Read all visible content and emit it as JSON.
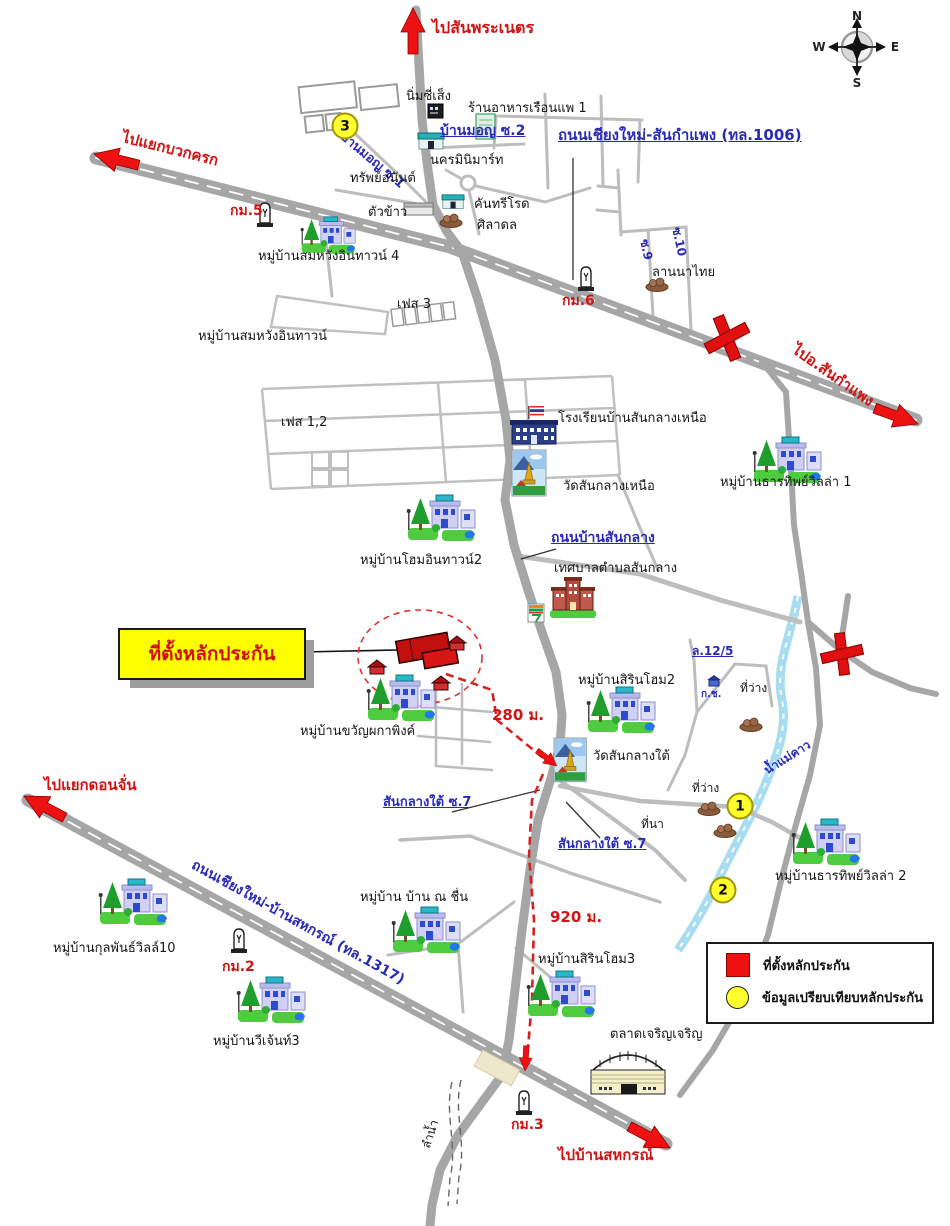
{
  "callout": {
    "label": "ที่ตั้งหลักประกัน"
  },
  "legend": {
    "items": [
      {
        "symbol": "red-square",
        "label": "ที่ตั้งหลักประกัน"
      },
      {
        "symbol": "yellow-circle",
        "label": "ข้อมูลเปรียบเทียบหลักประกัน"
      }
    ]
  },
  "compass": {
    "n": "N",
    "e": "E",
    "s": "S",
    "w": "W"
  },
  "colors": {
    "label_red": "#d01414",
    "label_blue": "#2a2ab8",
    "road_gray": "#a6a6a6",
    "route_red": "#d42222",
    "highlight_yellow": "#ffff00",
    "collateral_red": "#ee1111",
    "badge_yellow": "#ffff2e",
    "stream_blue": "#a8dcf0"
  },
  "map": {
    "labels": [
      {
        "id": "to-sanphranet",
        "text": "ไปสันพระเนตร",
        "x": 432,
        "y": 20,
        "size": 16,
        "color": "red"
      },
      {
        "id": "nim-si-seng",
        "text": "นิ่มซี่เส็ง",
        "x": 406,
        "y": 90,
        "size": 13,
        "color": "black"
      },
      {
        "id": "ruen-phae-restaurant",
        "text": "ร้านอาหารเรือนแพ 1",
        "x": 468,
        "y": 102,
        "size": 13,
        "color": "black"
      },
      {
        "id": "baan-mon-soi2",
        "text": "บ้านมอญ ซ.2",
        "x": 440,
        "y": 124,
        "size": 14,
        "color": "blue",
        "underline": true
      },
      {
        "id": "baan-mon-soi1",
        "text": "บ้านมอญ ซ.1",
        "x": 346,
        "y": 130,
        "size": 13,
        "color": "blue",
        "rot": 40
      },
      {
        "id": "nakorn-minimart",
        "text": "นครมินิมาร์ท",
        "x": 430,
        "y": 154,
        "size": 13,
        "color": "black"
      },
      {
        "id": "sap-anan",
        "text": "ทรัพย์อนันต์",
        "x": 350,
        "y": 172,
        "size": 13,
        "color": "black"
      },
      {
        "id": "tua-khao",
        "text": "ตัวข้าว",
        "x": 368,
        "y": 206,
        "size": 13,
        "color": "black"
      },
      {
        "id": "country-road",
        "text": "คันทรีโรด",
        "x": 474,
        "y": 198,
        "size": 13,
        "color": "black"
      },
      {
        "id": "siladon",
        "text": "ศิลาดล",
        "x": 477,
        "y": 219,
        "size": 13,
        "color": "black"
      },
      {
        "id": "road-1006",
        "text": "ถนนเชียงใหม่-สันกำแพง (ทล.1006)",
        "x": 558,
        "y": 128,
        "size": 15,
        "color": "blue",
        "underline": true
      },
      {
        "id": "to-yaek-buak-krok",
        "text": "ไปแยกบวกครก",
        "x": 124,
        "y": 130,
        "size": 15,
        "color": "red",
        "rot": 14
      },
      {
        "id": "km5",
        "text": "กม.5",
        "x": 230,
        "y": 204,
        "size": 14,
        "color": "red"
      },
      {
        "id": "somwang-intown4",
        "text": "หมู่บ้านสมหวังอินทาวน์ 4",
        "x": 258,
        "y": 250,
        "size": 13,
        "color": "black"
      },
      {
        "id": "km6",
        "text": "กม.6",
        "x": 562,
        "y": 294,
        "size": 14,
        "color": "red"
      },
      {
        "id": "soi9",
        "text": "ซ.9",
        "x": 650,
        "y": 238,
        "size": 12,
        "color": "blue",
        "rot": 78
      },
      {
        "id": "soi10",
        "text": "ซ.10",
        "x": 682,
        "y": 226,
        "size": 12,
        "color": "blue",
        "rot": 78
      },
      {
        "id": "lanna-thai",
        "text": "ลานนาไทย",
        "x": 652,
        "y": 266,
        "size": 13,
        "color": "black"
      },
      {
        "id": "to-sankamphaeng",
        "text": "ไปอ.สันกำแพง",
        "x": 798,
        "y": 342,
        "size": 15,
        "color": "red",
        "rot": 35
      },
      {
        "id": "phase3",
        "text": "เฟส 3",
        "x": 397,
        "y": 298,
        "size": 13,
        "color": "black"
      },
      {
        "id": "somwang-intown",
        "text": "หมู่บ้านสมหวังอินทาวน์",
        "x": 198,
        "y": 330,
        "size": 13,
        "color": "black"
      },
      {
        "id": "phase12",
        "text": "เฟส 1,2",
        "x": 281,
        "y": 416,
        "size": 13,
        "color": "black"
      },
      {
        "id": "school-sanklang-nuea",
        "text": "โรงเรียนบ้านสันกลางเหนือ",
        "x": 558,
        "y": 412,
        "size": 13,
        "color": "black"
      },
      {
        "id": "wat-sanklang-nuea",
        "text": "วัดสันกลางเหนือ",
        "x": 563,
        "y": 480,
        "size": 13,
        "color": "black"
      },
      {
        "id": "thantip-villa1",
        "text": "หมู่บ้านธารทิพย์วิลล่า 1",
        "x": 720,
        "y": 476,
        "size": 13,
        "color": "black"
      },
      {
        "id": "home-intown2",
        "text": "หมู่บ้านโฮมอินทาวน์2",
        "x": 360,
        "y": 554,
        "size": 13,
        "color": "black"
      },
      {
        "id": "road-ban-sanklang",
        "text": "ถนนบ้านสันกลาง",
        "x": 551,
        "y": 531,
        "size": 14,
        "color": "blue",
        "underline": true
      },
      {
        "id": "municipality-sanklang",
        "text": "เทศบาลตำบลสันกลาง",
        "x": 554,
        "y": 562,
        "size": 13,
        "color": "black"
      },
      {
        "id": "khwan-phaka-ping",
        "text": "หมู่บ้านขวัญผกาพิงค์",
        "x": 300,
        "y": 725,
        "size": 13,
        "color": "black"
      },
      {
        "id": "dist-280m",
        "text": "280 ม.",
        "x": 492,
        "y": 708,
        "size": 15,
        "color": "red"
      },
      {
        "id": "sirin-home2",
        "text": "หมู่บ้านสิรินโฮม2",
        "x": 578,
        "y": 674,
        "size": 13,
        "color": "black"
      },
      {
        "id": "wat-sanklang-tai",
        "text": "วัดสันกลางใต้",
        "x": 593,
        "y": 750,
        "size": 13,
        "color": "black"
      },
      {
        "id": "lane-12-5",
        "text": "ล.12/5",
        "x": 692,
        "y": 645,
        "size": 12,
        "color": "blue",
        "underline": true
      },
      {
        "id": "k-ch",
        "text": "ก.ช.",
        "x": 701,
        "y": 690,
        "size": 10,
        "color": "blue"
      },
      {
        "id": "vacant-1",
        "text": "ที่ว่าง",
        "x": 740,
        "y": 682,
        "size": 12,
        "color": "black"
      },
      {
        "id": "vacant-2",
        "text": "ที่ว่าง",
        "x": 692,
        "y": 782,
        "size": 12,
        "color": "black"
      },
      {
        "id": "rice-field",
        "text": "ที่นา",
        "x": 641,
        "y": 818,
        "size": 12,
        "color": "black"
      },
      {
        "id": "mae-khao-stream",
        "text": "น้ำแม่คาว",
        "x": 762,
        "y": 766,
        "size": 12,
        "color": "blue",
        "rot": -32
      },
      {
        "id": "thantip-villa2",
        "text": "หมู่บ้านธารทิพย์วิลล่า 2",
        "x": 775,
        "y": 870,
        "size": 13,
        "color": "black"
      },
      {
        "id": "sanklang-tai-soi7-a",
        "text": "สันกลางใต้ ซ.7",
        "x": 383,
        "y": 796,
        "size": 13,
        "color": "blue",
        "underline": true
      },
      {
        "id": "sanklang-tai-soi7-b",
        "text": "สันกลางใต้ ซ.7",
        "x": 558,
        "y": 838,
        "size": 13,
        "color": "blue",
        "underline": true
      },
      {
        "id": "baan-na-chuen",
        "text": "หมู่บ้าน บ้าน ณ ชื่น",
        "x": 360,
        "y": 891,
        "size": 13,
        "color": "black"
      },
      {
        "id": "dist-920m",
        "text": "920 ม.",
        "x": 550,
        "y": 910,
        "size": 15,
        "color": "red"
      },
      {
        "id": "sirin-home3",
        "text": "หมู่บ้านสิรินโฮม3",
        "x": 538,
        "y": 953,
        "size": 13,
        "color": "black"
      },
      {
        "id": "kulpan-ville10",
        "text": "หมู่บ้านกุลพันธ์วิลล์10",
        "x": 53,
        "y": 942,
        "size": 13,
        "color": "black"
      },
      {
        "id": "km2",
        "text": "กม.2",
        "x": 222,
        "y": 960,
        "size": 14,
        "color": "red"
      },
      {
        "id": "v-gent3",
        "text": "หมู่บ้านวีเจ้นท์3",
        "x": 213,
        "y": 1035,
        "size": 13,
        "color": "black"
      },
      {
        "id": "road-1317",
        "text": "ถนนเชียงใหม่-บ้านสหกรณ์ (ทล.1317)",
        "x": 196,
        "y": 858,
        "size": 14,
        "color": "blue",
        "rot": 29
      },
      {
        "id": "to-yaek-donchan",
        "text": "ไปแยกดอนจั่น",
        "x": 44,
        "y": 778,
        "size": 15,
        "color": "red"
      },
      {
        "id": "charoen-market",
        "text": "ตลาดเจริญเจริญ",
        "x": 610,
        "y": 1028,
        "size": 13,
        "color": "black"
      },
      {
        "id": "km3",
        "text": "กม.3",
        "x": 511,
        "y": 1118,
        "size": 14,
        "color": "red"
      },
      {
        "id": "to-ban-sahakorn",
        "text": "ไปบ้านสหกรณ์",
        "x": 558,
        "y": 1148,
        "size": 15,
        "color": "red"
      },
      {
        "id": "lam-nam",
        "text": "ลำน้ำ",
        "x": 420,
        "y": 1146,
        "size": 12,
        "color": "black",
        "rot": -72
      }
    ],
    "badges": [
      {
        "value": "3",
        "x": 345,
        "y": 126
      },
      {
        "value": "1",
        "x": 740,
        "y": 806
      },
      {
        "value": "2",
        "x": 723,
        "y": 890
      }
    ],
    "icons": [
      {
        "type": "shopdark",
        "x": 428,
        "y": 104,
        "name": "nim-si-seng-icon"
      },
      {
        "type": "signgreen",
        "x": 476,
        "y": 114,
        "name": "house-sign-icon"
      },
      {
        "type": "shopteal",
        "x": 418,
        "y": 132,
        "name": "minimart-icon"
      },
      {
        "type": "graybldg",
        "x": 404,
        "y": 203,
        "name": "tua-khao-icon"
      },
      {
        "type": "shopteal",
        "x": 442,
        "y": 194,
        "scale": 0.85,
        "name": "country-road-icon"
      },
      {
        "type": "mound",
        "x": 438,
        "y": 212,
        "name": "siladon-icon"
      },
      {
        "type": "km",
        "x": 256,
        "y": 200,
        "name": "km5-marker-icon"
      },
      {
        "type": "km",
        "x": 577,
        "y": 264,
        "name": "km6-marker-icon"
      },
      {
        "type": "mound",
        "x": 644,
        "y": 276,
        "name": "lanna-thai-icon"
      },
      {
        "type": "village",
        "x": 300,
        "y": 216,
        "scale": 0.8,
        "name": "somwang4-village-icon"
      },
      {
        "type": "school",
        "x": 510,
        "y": 406,
        "name": "school-icon"
      },
      {
        "type": "temple",
        "x": 512,
        "y": 450,
        "name": "wat-nuea-icon"
      },
      {
        "type": "village",
        "x": 752,
        "y": 436,
        "name": "thantip1-village-icon"
      },
      {
        "type": "village",
        "x": 406,
        "y": 494,
        "name": "home-intown2-village-icon"
      },
      {
        "type": "mun",
        "x": 550,
        "y": 576,
        "name": "municipality-icon"
      },
      {
        "type": "seven",
        "x": 528,
        "y": 604,
        "name": "seven-eleven-icon"
      },
      {
        "type": "village",
        "x": 366,
        "y": 674,
        "name": "khwan-village-icon"
      },
      {
        "type": "village",
        "x": 586,
        "y": 686,
        "name": "sirin2-village-icon"
      },
      {
        "type": "temple",
        "x": 554,
        "y": 738,
        "scale": 0.95,
        "name": "wat-tai-icon"
      },
      {
        "type": "redhouse",
        "x": 366,
        "y": 658,
        "name": "small-house-icon"
      },
      {
        "type": "redhouse",
        "x": 430,
        "y": 674,
        "name": "small-house-icon"
      },
      {
        "type": "redhouse",
        "x": 446,
        "y": 634,
        "name": "small-house-icon"
      },
      {
        "type": "bluehouse",
        "x": 706,
        "y": 674,
        "name": "small-house-icon"
      },
      {
        "type": "mound",
        "x": 738,
        "y": 716,
        "name": "dirt-mound-icon"
      },
      {
        "type": "mound",
        "x": 696,
        "y": 800,
        "name": "dirt-mound-icon"
      },
      {
        "type": "mound",
        "x": 712,
        "y": 822,
        "name": "dirt-mound-icon"
      },
      {
        "type": "village",
        "x": 791,
        "y": 818,
        "name": "thantip2-village-icon"
      },
      {
        "type": "village",
        "x": 391,
        "y": 906,
        "name": "na-chuen-village-icon"
      },
      {
        "type": "village",
        "x": 526,
        "y": 970,
        "name": "sirin3-village-icon"
      },
      {
        "type": "village",
        "x": 98,
        "y": 878,
        "name": "kulpan10-village-icon"
      },
      {
        "type": "village",
        "x": 236,
        "y": 976,
        "name": "v-gent3-village-icon"
      },
      {
        "type": "km",
        "x": 230,
        "y": 926,
        "name": "km2-marker-icon"
      },
      {
        "type": "km",
        "x": 515,
        "y": 1088,
        "name": "km3-marker-icon"
      },
      {
        "type": "market",
        "x": 583,
        "y": 1046,
        "name": "market-icon"
      }
    ],
    "arrows": [
      {
        "x": 413,
        "y": 8,
        "angle": -90,
        "scale": 1,
        "name": "arrow-north-sanphranet"
      },
      {
        "x": 94,
        "y": 154,
        "angle": 194,
        "scale": 1,
        "name": "arrow-west-buakkrok"
      },
      {
        "x": 918,
        "y": 424,
        "angle": 20,
        "scale": 1,
        "name": "arrow-east-sankamphaeng"
      },
      {
        "x": 24,
        "y": 796,
        "angle": 208,
        "scale": 1,
        "name": "arrow-west-donchan"
      },
      {
        "x": 670,
        "y": 1148,
        "angle": 28,
        "scale": 1,
        "name": "arrow-east-sahakorn"
      },
      {
        "x": 557,
        "y": 766,
        "angle": 38,
        "scale": 0.55,
        "name": "route-arrow-temple"
      },
      {
        "x": 525,
        "y": 1071,
        "angle": 93,
        "scale": 0.55,
        "name": "route-arrow-south"
      }
    ]
  }
}
